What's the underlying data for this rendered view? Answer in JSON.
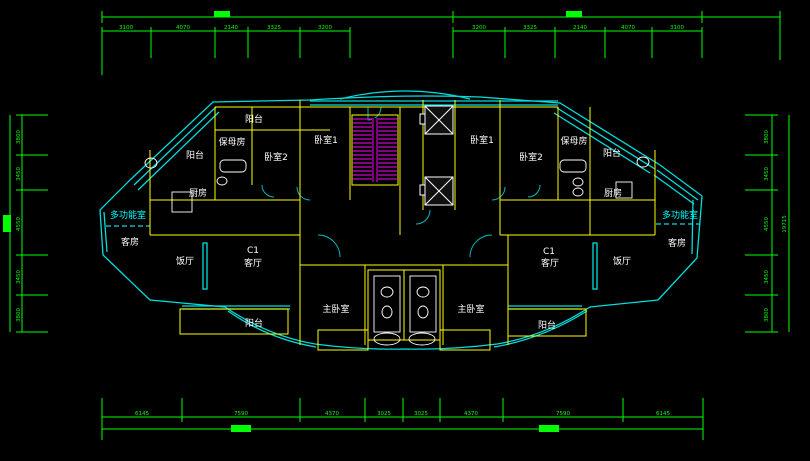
{
  "drawing": {
    "type": "architectural-floor-plan",
    "unit_code": "C1",
    "colors": {
      "background": "#000000",
      "dimension_green": "#00ff00",
      "wall_cyan": "#00e0e0",
      "interior_yellow": "#ffff00",
      "stair_magenta": "#cc00cc",
      "fixture_white": "#ffffff",
      "label_white": "#ffffff",
      "label_cyan": "#00ffff"
    },
    "rooms": [
      {
        "id": "balcony-top-left",
        "label": "阳台"
      },
      {
        "id": "nanny-room-left",
        "label": "保母房"
      },
      {
        "id": "balcony-left",
        "label": "阳台"
      },
      {
        "id": "bedroom2-left",
        "label": "卧室2"
      },
      {
        "id": "bedroom1-left",
        "label": "卧室1"
      },
      {
        "id": "kitchen-left",
        "label": "厨房"
      },
      {
        "id": "bedroom1-right",
        "label": "卧室1"
      },
      {
        "id": "bedroom2-right",
        "label": "卧室2"
      },
      {
        "id": "nanny-room-right",
        "label": "保母房"
      },
      {
        "id": "balcony-top-right",
        "label": "阳台"
      },
      {
        "id": "kitchen-right",
        "label": "厨房"
      },
      {
        "id": "multifunction-left",
        "label": "多功能室"
      },
      {
        "id": "guest-room-left",
        "label": "客房"
      },
      {
        "id": "multifunction-right",
        "label": "多功能室"
      },
      {
        "id": "guest-room-right",
        "label": "客房"
      },
      {
        "id": "dining-left",
        "label": "饭厅"
      },
      {
        "id": "unit-code-left",
        "label": "C1"
      },
      {
        "id": "living-left",
        "label": "客厅"
      },
      {
        "id": "unit-code-right",
        "label": "C1"
      },
      {
        "id": "living-right",
        "label": "客厅"
      },
      {
        "id": "dining-right",
        "label": "饭厅"
      },
      {
        "id": "master-bedroom-left",
        "label": "主卧室"
      },
      {
        "id": "master-bedroom-right",
        "label": "主卧室"
      },
      {
        "id": "balcony-bottom-left",
        "label": "阳台"
      },
      {
        "id": "balcony-bottom-right",
        "label": "阳台"
      }
    ],
    "dimensions": {
      "top_left": [
        "3100",
        "4070",
        "2140",
        "3325",
        "3200"
      ],
      "top_right": [
        "3200",
        "3325",
        "2140",
        "4070",
        "3100"
      ],
      "bottom": [
        "6145",
        "7590",
        "4370",
        "3025",
        "3025",
        "4370",
        "7590",
        "6145"
      ],
      "left_side": [
        "3800",
        "3450",
        "4550",
        "3450",
        "3800"
      ],
      "right_side": [
        "3800",
        "3450",
        "4550",
        "3450",
        "3800"
      ],
      "right_overall": "19715"
    }
  }
}
